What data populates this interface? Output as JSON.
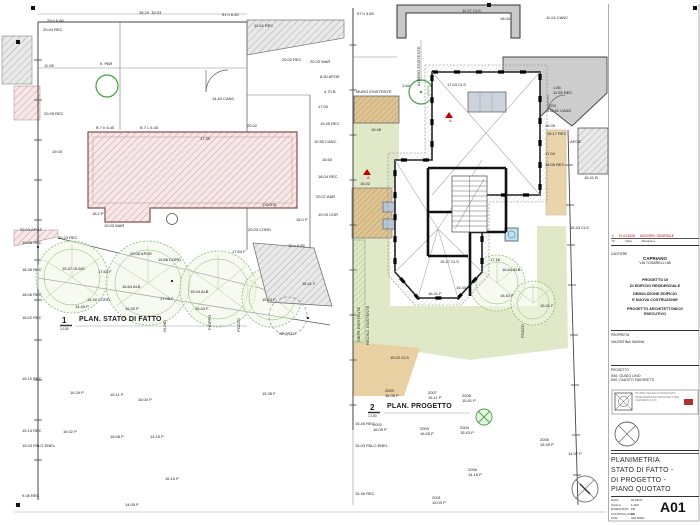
{
  "left_plan": {
    "number": "1",
    "title": "PLAN. STATO DI FATTO",
    "scale": "1:100",
    "labels": [
      {
        "x": 47,
        "y": 19,
        "t": "29 h 6.80"
      },
      {
        "x": 139,
        "y": 11,
        "t": "28.29  30.03"
      },
      {
        "x": 222,
        "y": 13,
        "t": "91 h 6.50"
      },
      {
        "x": 43,
        "y": 28,
        "t": "20.04 REC"
      },
      {
        "x": 254,
        "y": 24,
        "t": "11.04 REC"
      },
      {
        "x": 282,
        "y": 58,
        "t": "20.02 REC"
      },
      {
        "x": 44,
        "y": 64,
        "t": "11.08"
      },
      {
        "x": 100,
        "y": 62,
        "t": "h. PAR"
      },
      {
        "x": 212,
        "y": 97,
        "t": "14.84 CANC"
      },
      {
        "x": 44,
        "y": 112,
        "t": "20.05 REC"
      },
      {
        "x": 96,
        "y": 126,
        "t": "B 7 h 6.40"
      },
      {
        "x": 140,
        "y": 126,
        "t": "B 7 L 6.40"
      },
      {
        "x": 200,
        "y": 137,
        "t": "17.39"
      },
      {
        "x": 247,
        "y": 124,
        "t": "20.02"
      },
      {
        "x": 52,
        "y": 150,
        "t": "19.03"
      },
      {
        "x": 310,
        "y": 60,
        "t": "20.03 WAR"
      },
      {
        "x": 320,
        "y": 75,
        "t": "8.50 APOE"
      },
      {
        "x": 324,
        "y": 90,
        "t": "4.70 B"
      },
      {
        "x": 318,
        "y": 105,
        "t": "17.00"
      },
      {
        "x": 320,
        "y": 122,
        "t": "19.45 REC"
      },
      {
        "x": 314,
        "y": 140,
        "t": "10.55 CANC"
      },
      {
        "x": 322,
        "y": 158,
        "t": "16.63"
      },
      {
        "x": 318,
        "y": 175,
        "t": "18.04 REC"
      },
      {
        "x": 316,
        "y": 195,
        "t": "20.07 AAR"
      },
      {
        "x": 318,
        "y": 213,
        "t": "19.03 COR"
      },
      {
        "x": 92,
        "y": 212,
        "t": "18.2 P"
      },
      {
        "x": 104,
        "y": 224,
        "t": "19.03 WAR"
      },
      {
        "x": 263,
        "y": 203,
        "t": "(XXXX)"
      },
      {
        "x": 296,
        "y": 218,
        "t": "18.0 P"
      },
      {
        "x": 20,
        "y": 228,
        "t": "20.03 APOZ"
      },
      {
        "x": 248,
        "y": 228,
        "t": "20.03 CORD"
      },
      {
        "x": 58,
        "y": 236,
        "t": "20.23 REC"
      },
      {
        "x": 22,
        "y": 241,
        "t": "19.08 REC"
      },
      {
        "x": 130,
        "y": 252,
        "t": "19.06 APOE"
      },
      {
        "x": 158,
        "y": 258,
        "t": "19.66 CORD"
      },
      {
        "x": 232,
        "y": 250,
        "t": "17.54 F"
      },
      {
        "x": 288,
        "y": 244,
        "t": "19 h 6.85"
      },
      {
        "x": 22,
        "y": 268,
        "t": "18.35 REC"
      },
      {
        "x": 62,
        "y": 267,
        "t": "15.47 OLMO"
      },
      {
        "x": 98,
        "y": 270,
        "t": "17.63 F"
      },
      {
        "x": 22,
        "y": 293,
        "t": "18.06 REC"
      },
      {
        "x": 87,
        "y": 298,
        "t": "14.40 CORD"
      },
      {
        "x": 122,
        "y": 285,
        "t": "16.64 ALB"
      },
      {
        "x": 190,
        "y": 290,
        "t": "15.04 ALB"
      },
      {
        "x": 160,
        "y": 297,
        "t": "17.05 F"
      },
      {
        "x": 302,
        "y": 282,
        "t": "16.41 F"
      },
      {
        "x": 75,
        "y": 305,
        "t": "14.40 P"
      },
      {
        "x": 125,
        "y": 307,
        "t": "16.30 P"
      },
      {
        "x": 195,
        "y": 307,
        "t": "15.43 F"
      },
      {
        "x": 262,
        "y": 298,
        "t": "15.43 F"
      },
      {
        "x": 22,
        "y": 316,
        "t": "16.02 REC"
      },
      {
        "x": 279,
        "y": 332,
        "t": "SPORTO"
      },
      {
        "x": 163,
        "y": 332,
        "t": "OLMO",
        "v": 1
      },
      {
        "x": 208,
        "y": 330,
        "t": "PIOPPO",
        "v": 1
      },
      {
        "x": 237,
        "y": 332,
        "t": "POZZO",
        "v": 1
      },
      {
        "x": 262,
        "y": 392,
        "t": "15.35 F"
      },
      {
        "x": 22,
        "y": 377,
        "t": "15.10 REC"
      },
      {
        "x": 70,
        "y": 391,
        "t": "16.29 P"
      },
      {
        "x": 110,
        "y": 393,
        "t": "15.11 P"
      },
      {
        "x": 138,
        "y": 398,
        "t": "16.00 P"
      },
      {
        "x": 22,
        "y": 429,
        "t": "15.14 REC"
      },
      {
        "x": 63,
        "y": 430,
        "t": "16.02 P"
      },
      {
        "x": 110,
        "y": 435,
        "t": "16.08 P"
      },
      {
        "x": 150,
        "y": 435,
        "t": "14.15 P"
      },
      {
        "x": 22,
        "y": 444,
        "t": "15.03 PALO ENEL"
      },
      {
        "x": 165,
        "y": 477,
        "t": "16.16 P"
      },
      {
        "x": 22,
        "y": 494,
        "t": "9.08 REC"
      },
      {
        "x": 125,
        "y": 503,
        "t": "14.05 P"
      }
    ]
  },
  "right_plan": {
    "number": "2",
    "title": "PLAN. PROGETTO",
    "scale": "1:100",
    "labels": [
      {
        "x": 357,
        "y": 12,
        "t": "97 h 3.85"
      },
      {
        "x": 462,
        "y": 9,
        "t": "11.07 CLS"
      },
      {
        "x": 500,
        "y": 17,
        "t": "18.04"
      },
      {
        "x": 546,
        "y": 16,
        "t": "11.04 CANC"
      },
      {
        "x": 356,
        "y": 90,
        "t": "MURO ESISTENTE"
      },
      {
        "x": 402,
        "y": 84,
        "t": "1.64"
      },
      {
        "x": 447,
        "y": 83,
        "t": "17.04 CLS"
      },
      {
        "x": 553,
        "y": 86,
        "t": "1.65"
      },
      {
        "x": 553,
        "y": 91,
        "t": "11.55 REC"
      },
      {
        "x": 549,
        "y": 104,
        "t": "GSI"
      },
      {
        "x": 549,
        "y": 109,
        "t": "10.61 CANC"
      },
      {
        "x": 545,
        "y": 124,
        "t": "16.05"
      },
      {
        "x": 547,
        "y": 132,
        "t": "18.17 REC"
      },
      {
        "x": 570,
        "y": 140,
        "t": "APOE"
      },
      {
        "x": 545,
        "y": 152,
        "t": "17.04"
      },
      {
        "x": 545,
        "y": 163,
        "t": "18.06 REC"
      },
      {
        "x": 584,
        "y": 176,
        "t": "16.41 B"
      },
      {
        "x": 570,
        "y": 226,
        "t": "15.43 CLS"
      },
      {
        "x": 417,
        "y": 86,
        "t": "ALBERO ESISTENTE",
        "v": 1
      },
      {
        "x": 357,
        "y": 342,
        "t": "SIEPE ESISTENTE",
        "v": 1
      },
      {
        "x": 366,
        "y": 345,
        "t": "RECINZ. ESISTENTE",
        "v": 1
      },
      {
        "x": 521,
        "y": 338,
        "t": "POZZO",
        "v": 1
      },
      {
        "x": 371,
        "y": 128,
        "t": "15.45"
      },
      {
        "x": 360,
        "y": 182,
        "t": "16.02"
      },
      {
        "x": 449,
        "y": 119,
        "t": "A",
        "c": "#c00000"
      },
      {
        "x": 367,
        "y": 176,
        "t": "A",
        "c": "#c00000"
      },
      {
        "x": 440,
        "y": 260,
        "t": "15.27 CLS"
      },
      {
        "x": 490,
        "y": 258,
        "t": "17.16"
      },
      {
        "x": 502,
        "y": 268,
        "t": "16.64 ALB"
      },
      {
        "x": 456,
        "y": 286,
        "t": "15.43"
      },
      {
        "x": 428,
        "y": 292,
        "t": "16.41 F"
      },
      {
        "x": 500,
        "y": 294,
        "t": "15.43 F"
      },
      {
        "x": 540,
        "y": 304,
        "t": "15.41 F"
      },
      {
        "x": 390,
        "y": 356,
        "t": "15.02 CLS"
      },
      {
        "x": 385,
        "y": 389,
        "t": "2009\n16.05 P"
      },
      {
        "x": 428,
        "y": 391,
        "t": "2007\n15.11 P"
      },
      {
        "x": 462,
        "y": 394,
        "t": "2008\n15.81 P"
      },
      {
        "x": 373,
        "y": 423,
        "t": "2002\n16.05 P"
      },
      {
        "x": 420,
        "y": 427,
        "t": "2003\n16.05 P"
      },
      {
        "x": 460,
        "y": 426,
        "t": "2004\n15.43 P"
      },
      {
        "x": 540,
        "y": 438,
        "t": "2005\n15.45 P"
      },
      {
        "x": 468,
        "y": 468,
        "t": "2006\n14.16 P"
      },
      {
        "x": 432,
        "y": 496,
        "t": "2001\n15.03 P"
      },
      {
        "x": 355,
        "y": 422,
        "t": "15.45 REC"
      },
      {
        "x": 355,
        "y": 444,
        "t": "15.03 PALO ENEL"
      },
      {
        "x": 355,
        "y": 492,
        "t": "15.36 REC"
      },
      {
        "x": 568,
        "y": 452,
        "t": "14.97 P"
      }
    ]
  },
  "titleblock": {
    "revision": {
      "num": "1",
      "date": "21.03.2008",
      "desc": "AGGIORN. GENERALE",
      "col_num": "N°",
      "col_date": "Data",
      "col_desc": "Revisione"
    },
    "site_label": "CANTIERE",
    "site_city": "CAPRIANO",
    "site_address": "VIA TOSARELLI 88",
    "project_lines": [
      "PROGETTO DI",
      "DI EDIFICIO RESIDENZIALE",
      "DEMOLIZIONE EDIFICIO",
      "E NUOVA COSTRUZIONE",
      "PROGETTO ARCHITETTONICO",
      "ESECUTIVO"
    ],
    "owner_label": "PROPRIETA'",
    "owner": "VALENTINA SAVINA",
    "designer_label": "PROGETTO",
    "designers": [
      "ING. GUIDO LINO",
      "ING. FAUSTO FAVORETTI"
    ],
    "firm_lines": [
      "STUDIO TECNICO ASSOCIATO",
      "INGEGNERIA ED ARCHITETTURA",
      "CAPRIANO (CO)"
    ],
    "drawing_title_lines": [
      "PLANIMETRIA",
      "STATO DI FATTO -",
      "DI PROGETTO -",
      "PIANO QUOTATO"
    ],
    "info_rows": [
      {
        "k": "DATA",
        "v": "04.08.07"
      },
      {
        "k": "SCALA",
        "v": "1:100"
      },
      {
        "k": "DISEGNATO",
        "v": "FB"
      },
      {
        "k": "CONTROLLATO",
        "v": "FB"
      },
      {
        "k": "FILE",
        "v": "A01.DWG"
      }
    ],
    "sheet_number": "A01"
  }
}
